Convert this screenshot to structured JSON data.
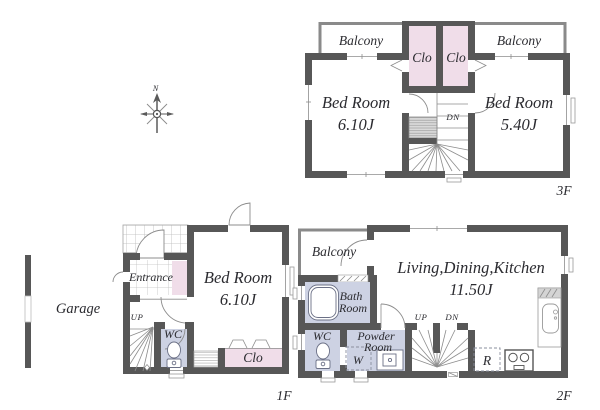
{
  "colors": {
    "wall": "#575757",
    "closet_pink": "#f0dde9",
    "wet_area_blue": "#cdd2e3",
    "balcony_wall_gray": "#8a8a8a",
    "thin_line_gray": "#8c8c8c",
    "text": "#2b2b30"
  },
  "compass": {
    "north_label": "N"
  },
  "floor_3f": {
    "floor_label": "3F",
    "balcony_left_label": "Balcony",
    "balcony_right_label": "Balcony",
    "closet_left_label": "Clo",
    "closet_right_label": "Clo",
    "bedroom_left_name": "Bed Room",
    "bedroom_left_size": "6.10J",
    "bedroom_right_name": "Bed Room",
    "bedroom_right_size": "5.40J",
    "stairs_down_label": "DN"
  },
  "floor_2f": {
    "floor_label": "2F",
    "balcony_label": "Balcony",
    "ldk_name": "Living,Dining,Kitchen",
    "ldk_size": "11.50J",
    "bathroom_name_line1": "Bath",
    "bathroom_name_line2": "Room",
    "toilet_label": "WC",
    "powder_room_line1": "Powder",
    "powder_room_line2": "Room",
    "washing_machine_label": "W",
    "stairs_up_label": "UP",
    "stairs_down_label": "DN",
    "refrigerator_label": "R"
  },
  "floor_1f": {
    "floor_label": "1F",
    "garage_label": "Garage",
    "entrance_label": "Entrance",
    "bedroom_name": "Bed Room",
    "bedroom_size": "6.10J",
    "stairs_up_label": "UP",
    "toilet_label": "WC",
    "closet_label": "Clo"
  }
}
